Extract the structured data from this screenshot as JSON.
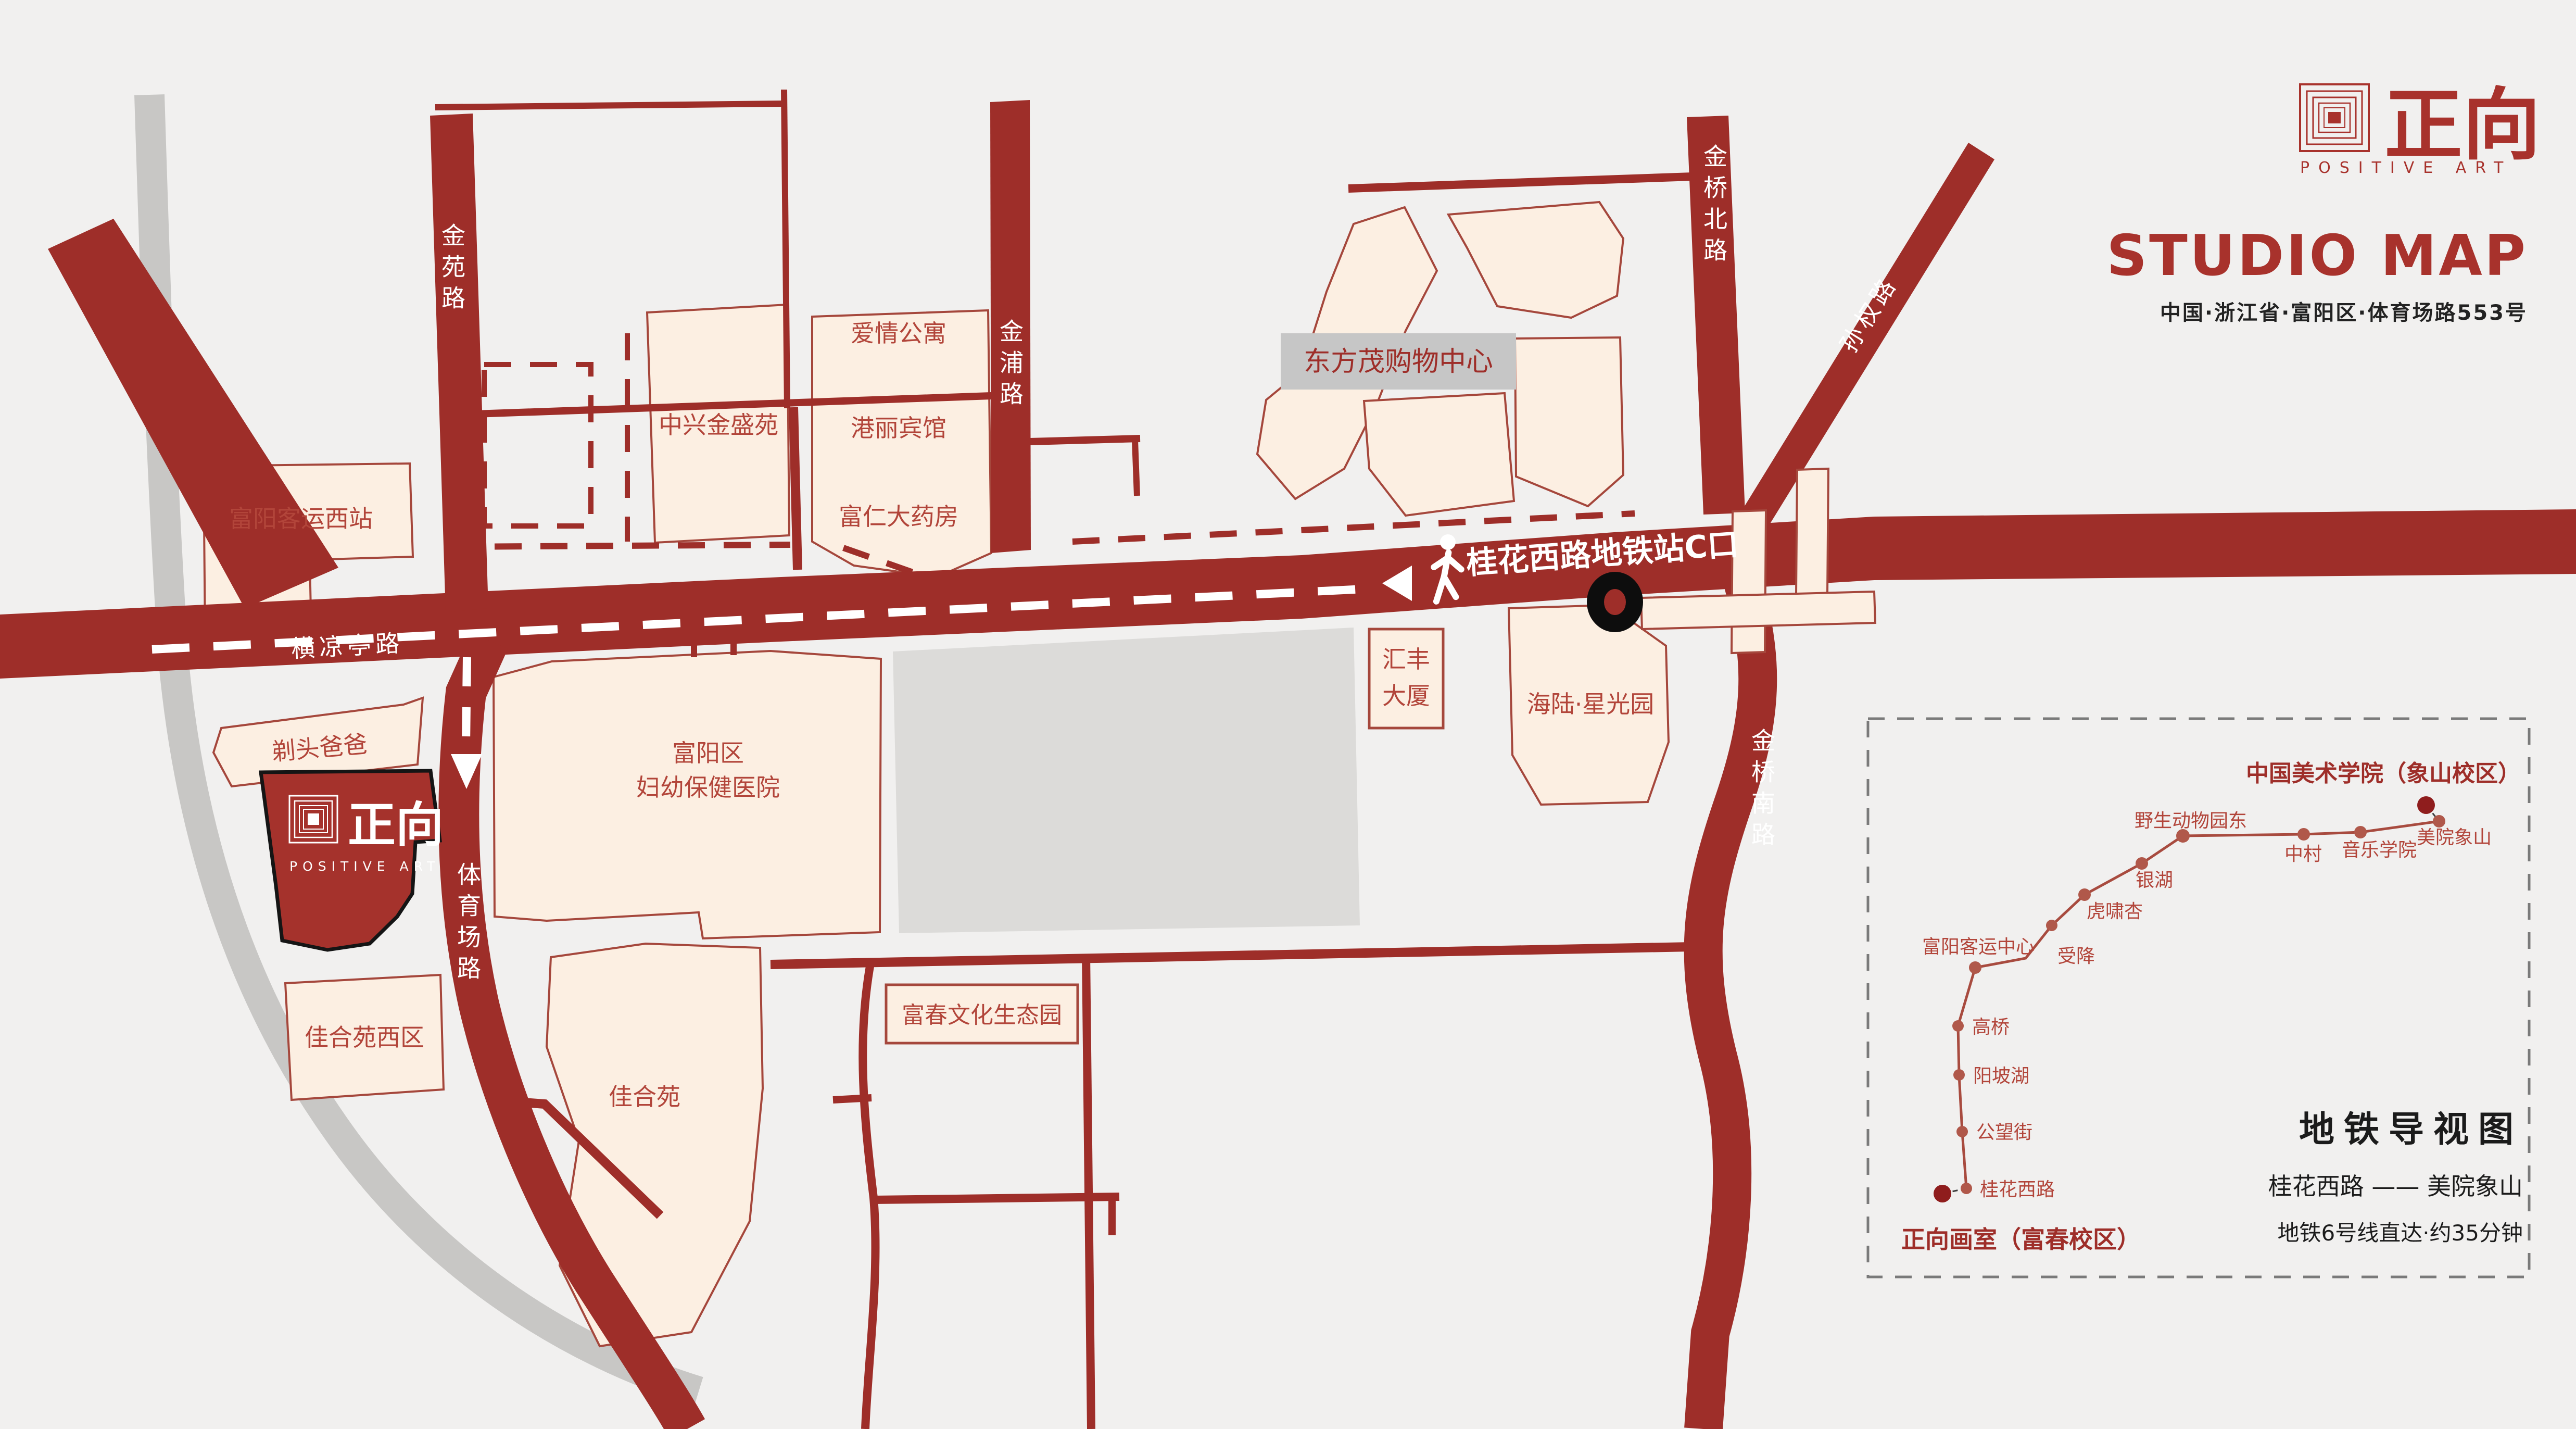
{
  "brand": {
    "logo_cn": "正向",
    "logo_en": "POSITIVE ART",
    "title": "STUDIO MAP",
    "address": "中国·浙江省·富阳区·体育场路553号"
  },
  "studio_building": {
    "logo_cn": "正向",
    "logo_en": "POSITIVE ART"
  },
  "roads": {
    "jin_yuan": "金苑路",
    "jin_pu": "金浦路",
    "heng_liang_ting": "横凉亭路",
    "ti_yu_chang": "体育场路",
    "jin_qiao_north": "金桥北路",
    "jin_qiao_south": "金桥南路",
    "sun_quan": "孙权路"
  },
  "places": {
    "west_bus_station": "富阳客运西站",
    "zhongxing": "中兴金盛苑",
    "apartment": "爱情公寓",
    "hotel": "港丽宾馆",
    "pharmacy": "富仁大药房",
    "dongfangmao": "东方茂购物中心",
    "huifeng_line1": "汇丰",
    "huifeng_line2": "大厦",
    "hailu": "海陆·星光园",
    "hospital_line1": "富阳区",
    "hospital_line2": "妇幼保健医院",
    "titou": "剃头爸爸",
    "jiaheyuan_west": "佳合苑西区",
    "jiaheyuan": "佳合苑",
    "ecology_park": "富春文化生态园"
  },
  "annotations": {
    "metro_exit": "桂花西路地铁站C口"
  },
  "metro": {
    "panel_title": "地铁导视图",
    "route": "桂花西路 —— 美院象山",
    "note": "地铁6号线直达·约35分钟",
    "start_label": "正向画室（富春校区）",
    "end_label": "中国美术学院（象山校区）",
    "stations": [
      "桂花西路",
      "公望街",
      "阳坡湖",
      "高桥",
      "富阳客运中心",
      "受降",
      "虎啸杏",
      "银湖",
      "野生动物园东",
      "中村",
      "音乐学院",
      "美院象山"
    ]
  },
  "colors": {
    "road_red": "#9e2e29",
    "studio_red": "#a5322c",
    "building_cream": "#fcefe2",
    "label_red": "#b2453a",
    "brand_red": "#a8322c",
    "gray_road": "#c8c7c5",
    "gray_block": "#dcdbd9",
    "metro_line": "#a84b3f",
    "metro_endpoint": "#8f1d1d"
  }
}
